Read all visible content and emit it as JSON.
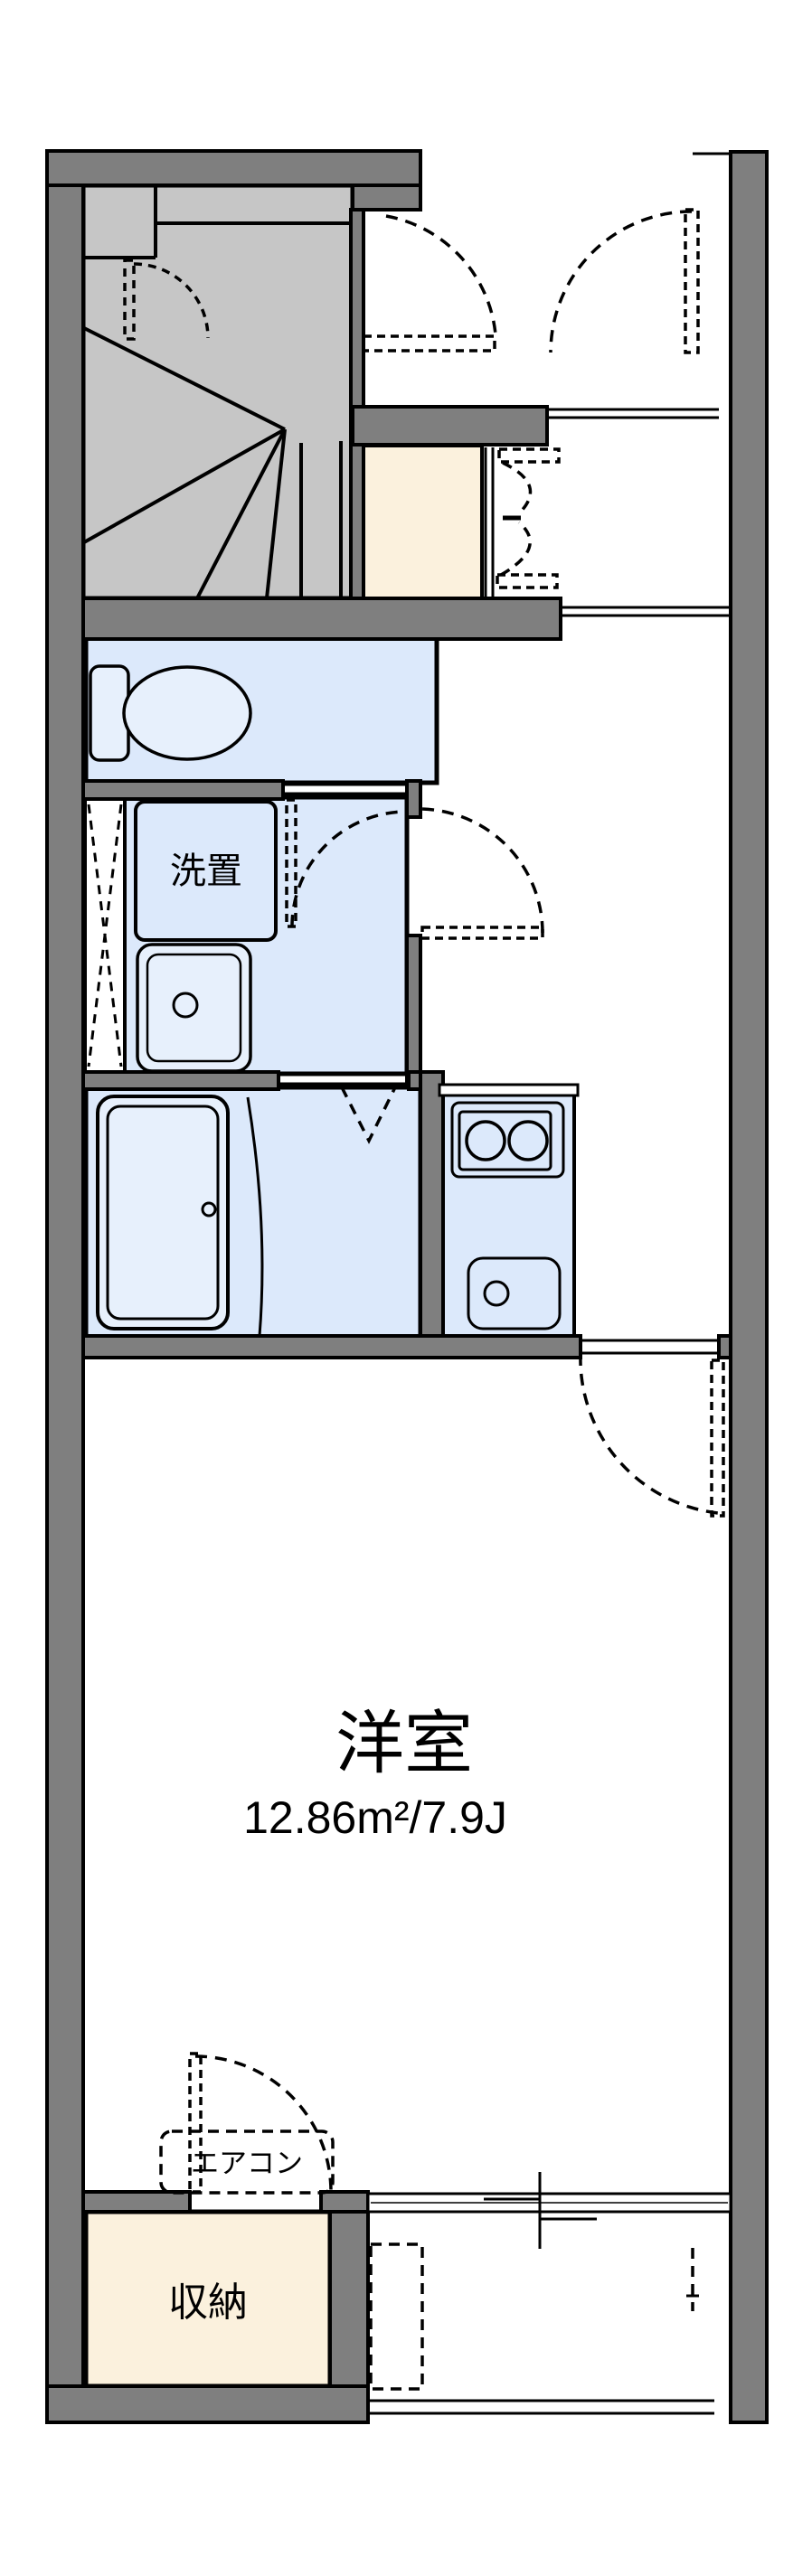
{
  "floorplan": {
    "type": "apartment-floor-plan",
    "rooms": {
      "main": {
        "name": "洋室",
        "area": "12.86m²/7.9J"
      },
      "washer_place": {
        "name": "洗置"
      },
      "storage": {
        "name": "収納"
      },
      "aircon": {
        "name": "エアコン"
      }
    },
    "features": [
      "staircase",
      "toilet",
      "washbasin",
      "bathtub",
      "kitchen-2-burner",
      "balcony",
      "entrance"
    ],
    "colors": {
      "wall": "#7f7f7f",
      "wet_floor": "#dce9fb",
      "stairs": "#c6c6c6",
      "storage_floor": "#fbf1dd",
      "line": "#000000",
      "background": "#ffffff"
    }
  }
}
